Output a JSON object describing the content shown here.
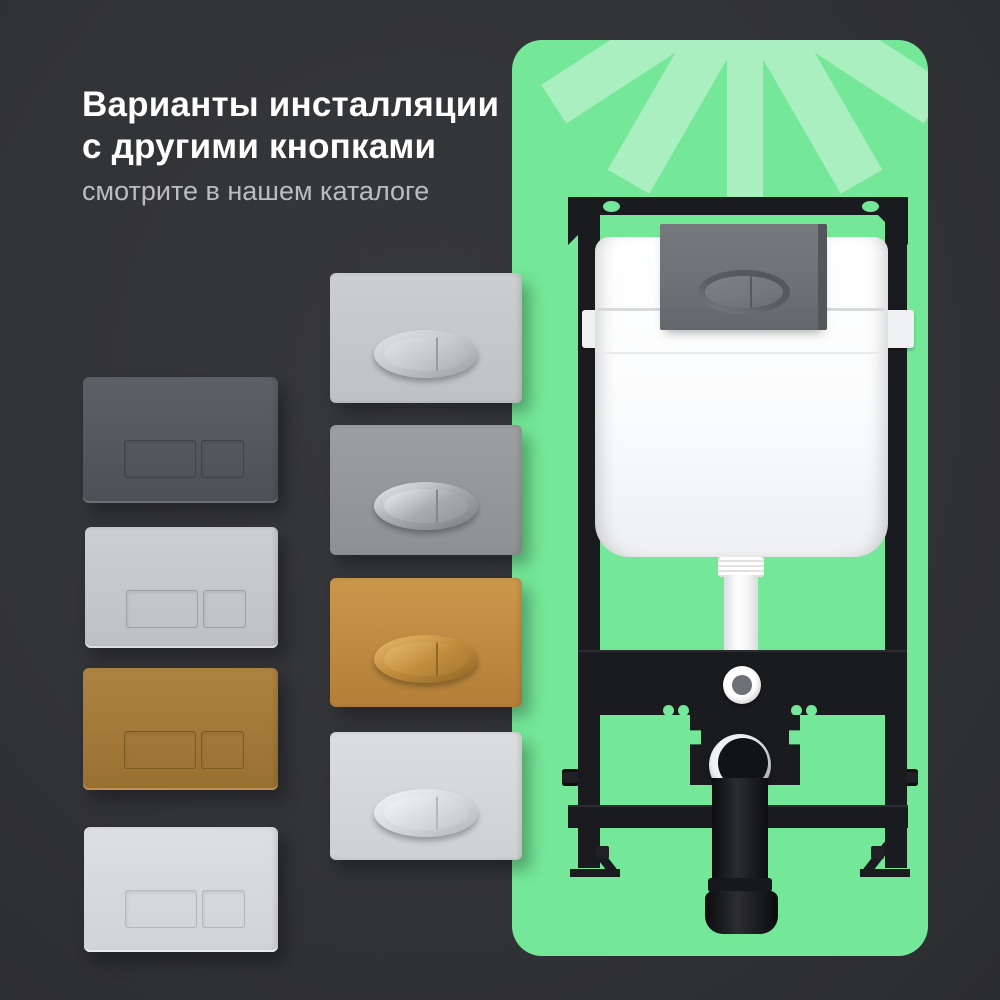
{
  "header": {
    "title_line1": "Варианты инсталляции",
    "title_line2": "с другими кнопками",
    "subtitle": "смотрите в нашем каталоге"
  },
  "theme": {
    "background": "#323337",
    "title_color": "#ffffff",
    "subtitle_color": "#bcbdbf",
    "panel_green": "#75e798",
    "ray_green": "#a9efbf",
    "frame_black": "#1a1b1e",
    "cistern_white": "#ffffff",
    "installed_plate_gray": "#6e7277",
    "installed_ring": "#5a5e63",
    "installed_button": "#74787d",
    "installed_divider": "#565a5f",
    "installed_edge": "#53565b"
  },
  "square_plates": [
    {
      "id": "dark-gray",
      "name": "flush plate dark gray, square buttons",
      "body_top": "#5d6065",
      "body_bottom": "#4d5055",
      "outline": "#3f4246",
      "edge": "#6b6e73"
    },
    {
      "id": "light-gray",
      "name": "flush plate light gray, square buttons",
      "body_top": "#cdcfd2",
      "body_bottom": "#bec0c3",
      "outline": "#9fa1a4",
      "edge": "#dddfe2"
    },
    {
      "id": "bronze",
      "name": "flush plate bronze gold, square buttons",
      "body_top": "#ae8341",
      "body_bottom": "#987030",
      "outline": "#7a5a23",
      "edge": "#bd9250"
    },
    {
      "id": "white",
      "name": "flush plate white, square buttons",
      "body_top": "#dddfe3",
      "body_bottom": "#d1d3d7",
      "outline": "#b5b7bb",
      "edge": "#e9ebef"
    }
  ],
  "oval_plates": [
    {
      "id": "silver",
      "name": "flush plate matte silver, oval button",
      "body_top": "#ccced1",
      "body_bottom": "#bfc1c4",
      "ring_hi": "#e2e4e7",
      "ring_lo": "#9b9da0",
      "inner": "#c6c8cb",
      "divider": "#999b9e"
    },
    {
      "id": "gray",
      "name": "flush plate gray, chrome oval button",
      "body_top": "#9c9ea1",
      "body_bottom": "#8e9093",
      "ring_hi": "#edeff1",
      "ring_lo": "#797b7e",
      "inner": "#a8aaad",
      "divider": "#85878a"
    },
    {
      "id": "gold",
      "name": "flush plate gold, oval button",
      "body_top": "#ca984b",
      "body_bottom": "#b37f38",
      "ring_hi": "#e7bc6e",
      "ring_lo": "#8a6424",
      "inner": "#c18d3d",
      "divider": "#8f6827"
    },
    {
      "id": "white",
      "name": "flush plate white, oval button",
      "body_top": "#dbdddf",
      "body_bottom": "#ced0d2",
      "ring_hi": "#f4f6f8",
      "ring_lo": "#b2b4b6",
      "inner": "#d8dadc",
      "divider": "#b6b8ba"
    }
  ],
  "installation": {
    "description": "concealed cistern installation frame with mounted gray flush plate"
  }
}
